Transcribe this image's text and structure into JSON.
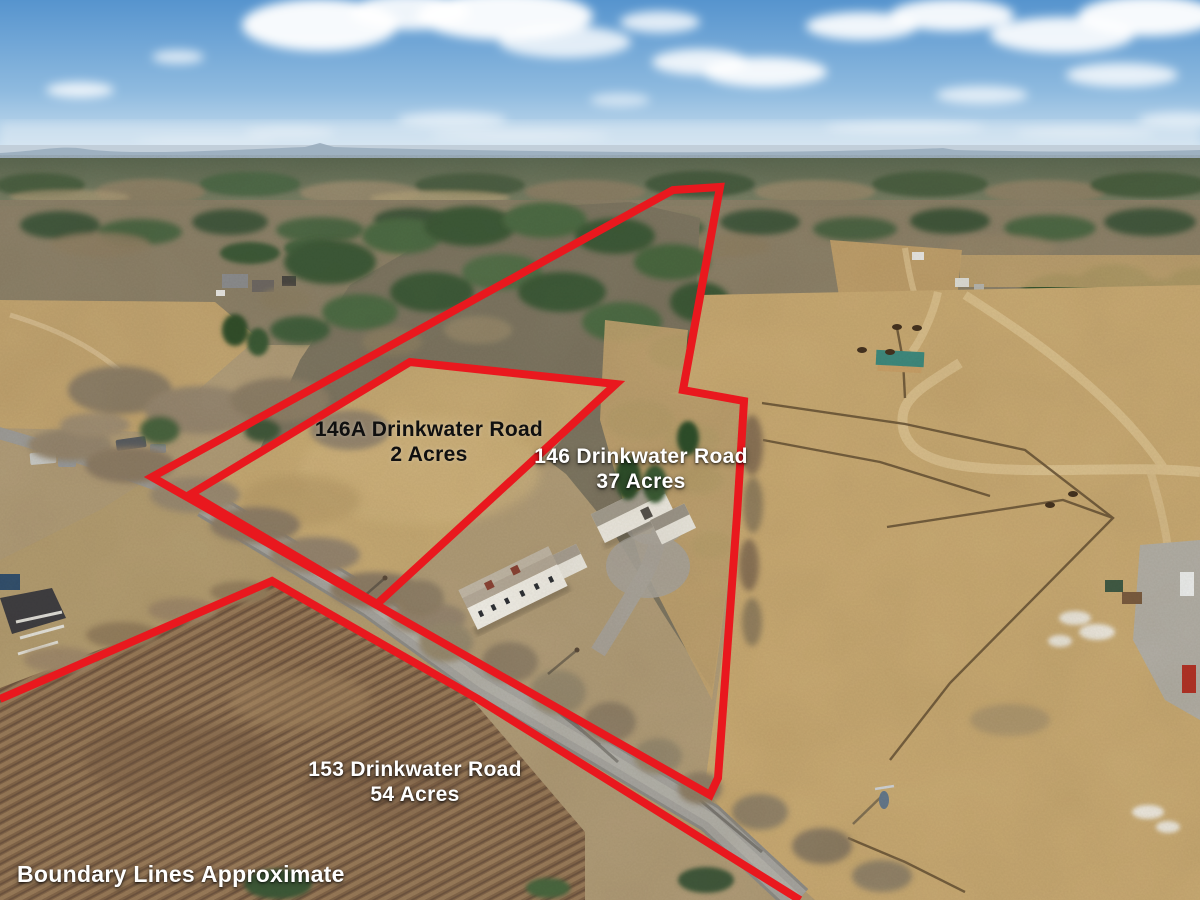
{
  "canvas": {
    "width": 1200,
    "height": 900
  },
  "colors": {
    "boundary_red": "#e9181e",
    "label_white": "#ffffff",
    "label_black": "#101010"
  },
  "disclaimer": {
    "text": "Boundary Lines Approximate",
    "x": 17,
    "y": 861,
    "color": "#ffffff"
  },
  "parcels": [
    {
      "name": "146A Drinkwater Road",
      "acres": "2 Acres",
      "label": {
        "x": 429,
        "y": 417,
        "color": "#101010",
        "style": "dark"
      },
      "boundary": [
        [
          410,
          362
        ],
        [
          616,
          384
        ],
        [
          377,
          604
        ],
        [
          191,
          494
        ]
      ]
    },
    {
      "name": "146 Drinkwater Road",
      "acres": "37 Acres",
      "label": {
        "x": 641,
        "y": 444,
        "color": "#ffffff",
        "style": "white"
      },
      "boundary": [
        [
          152,
          477
        ],
        [
          673,
          190
        ],
        [
          720,
          187
        ],
        [
          683,
          390
        ],
        [
          744,
          401
        ],
        [
          737,
          515
        ],
        [
          718,
          778
        ],
        [
          710,
          795
        ]
      ]
    },
    {
      "name": "153 Drinkwater Road",
      "acres": "54 Acres",
      "label": {
        "x": 415,
        "y": 757,
        "color": "#ffffff",
        "style": "white"
      },
      "boundary": [
        [
          0,
          699
        ],
        [
          272,
          581
        ],
        [
          478,
          699
        ],
        [
          800,
          900
        ]
      ]
    }
  ]
}
